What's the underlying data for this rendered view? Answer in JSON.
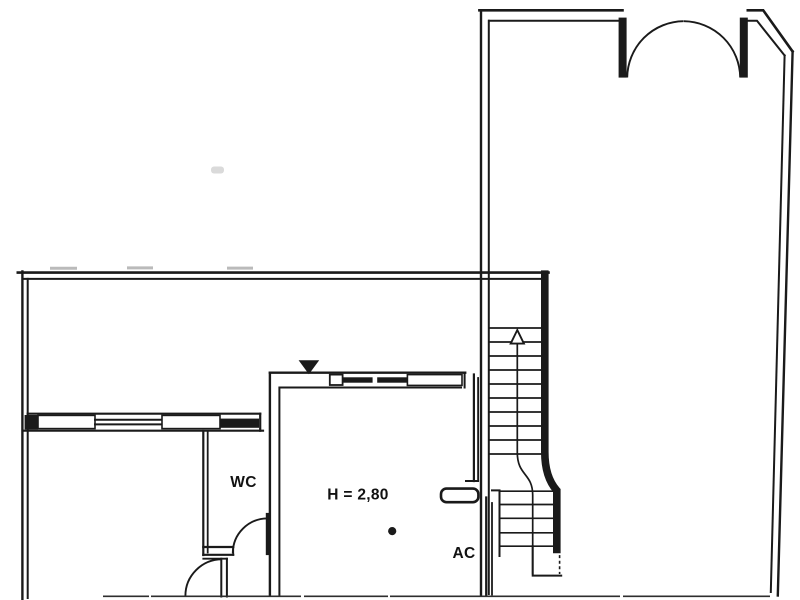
{
  "floor_plan": {
    "rooms": {
      "wc_label": "WC",
      "main_room_height_label": "H = 2,80",
      "ac_label": "AC"
    },
    "symbols": {
      "stair_direction": "up-arrow",
      "entrance_level_marker": "filled-down-triangle",
      "floor_dot_marker": "dot"
    },
    "colors": {
      "ink": "#1a1a1a",
      "paper": "#ffffff"
    }
  }
}
